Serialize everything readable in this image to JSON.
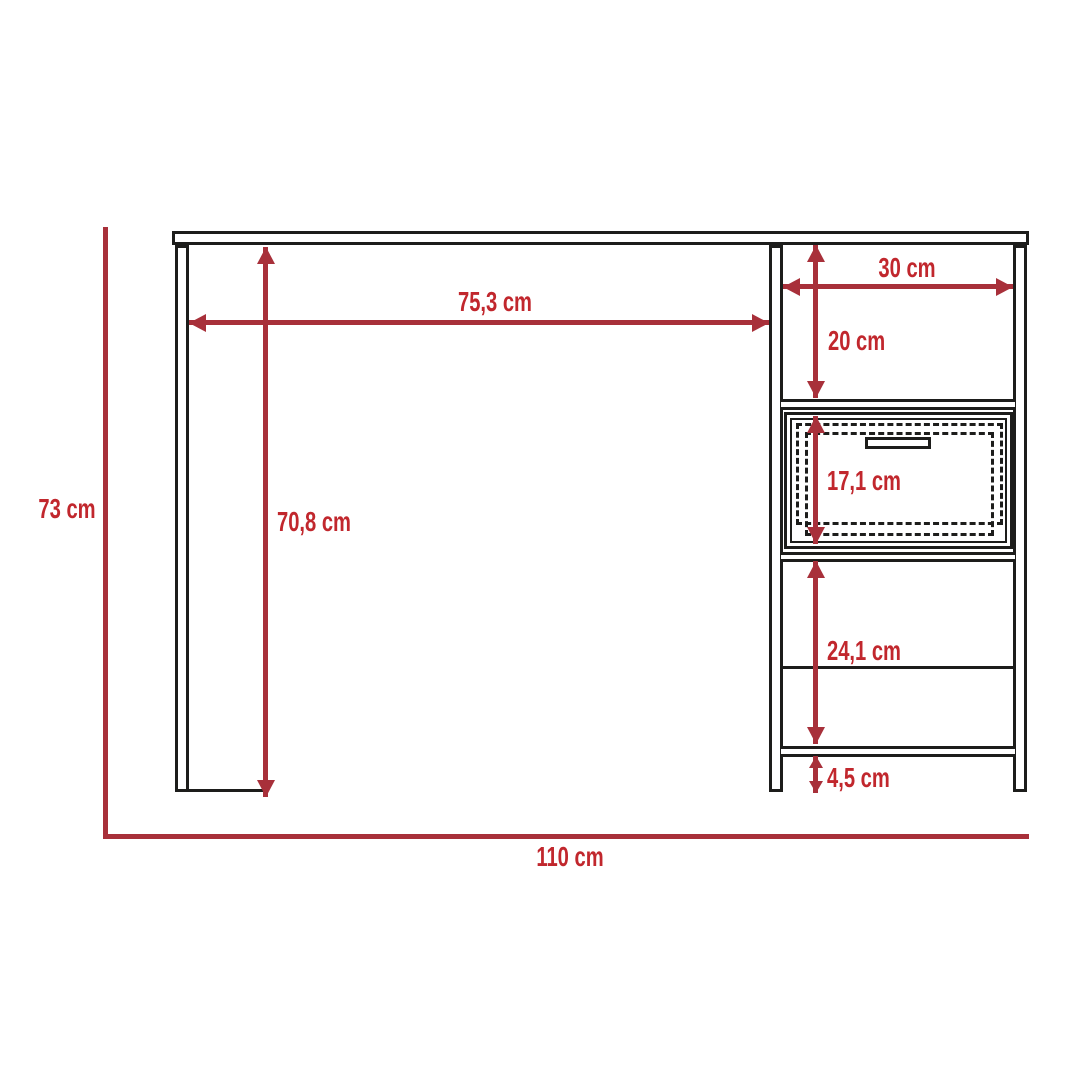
{
  "diagram": {
    "type": "furniture-dimension-drawing",
    "subject": "desk with side shelf tower and drawer, front elevation",
    "unit": "cm",
    "colors": {
      "line_red": "#a8303a",
      "text_red": "#c1272d",
      "outline_black": "#1d1d1b",
      "background": "#ffffff"
    },
    "dimensions": {
      "overall_height": {
        "label": "73 cm",
        "value": 73
      },
      "overall_width": {
        "label": "110 cm",
        "value": 110
      },
      "desktop_clear_span": {
        "label": "75,3 cm",
        "value": 75.3
      },
      "leg_height": {
        "label": "70,8 cm",
        "value": 70.8
      },
      "cabinet_width": {
        "label": "30 cm",
        "value": 30
      },
      "top_shelf_height": {
        "label": "20 cm",
        "value": 20
      },
      "drawer_height": {
        "label": "17,1 cm",
        "value": 17.1
      },
      "lower_shelf_height": {
        "label": "24,1 cm",
        "value": 24.1
      },
      "base_height": {
        "label": "4,5 cm",
        "value": 4.5
      }
    }
  }
}
